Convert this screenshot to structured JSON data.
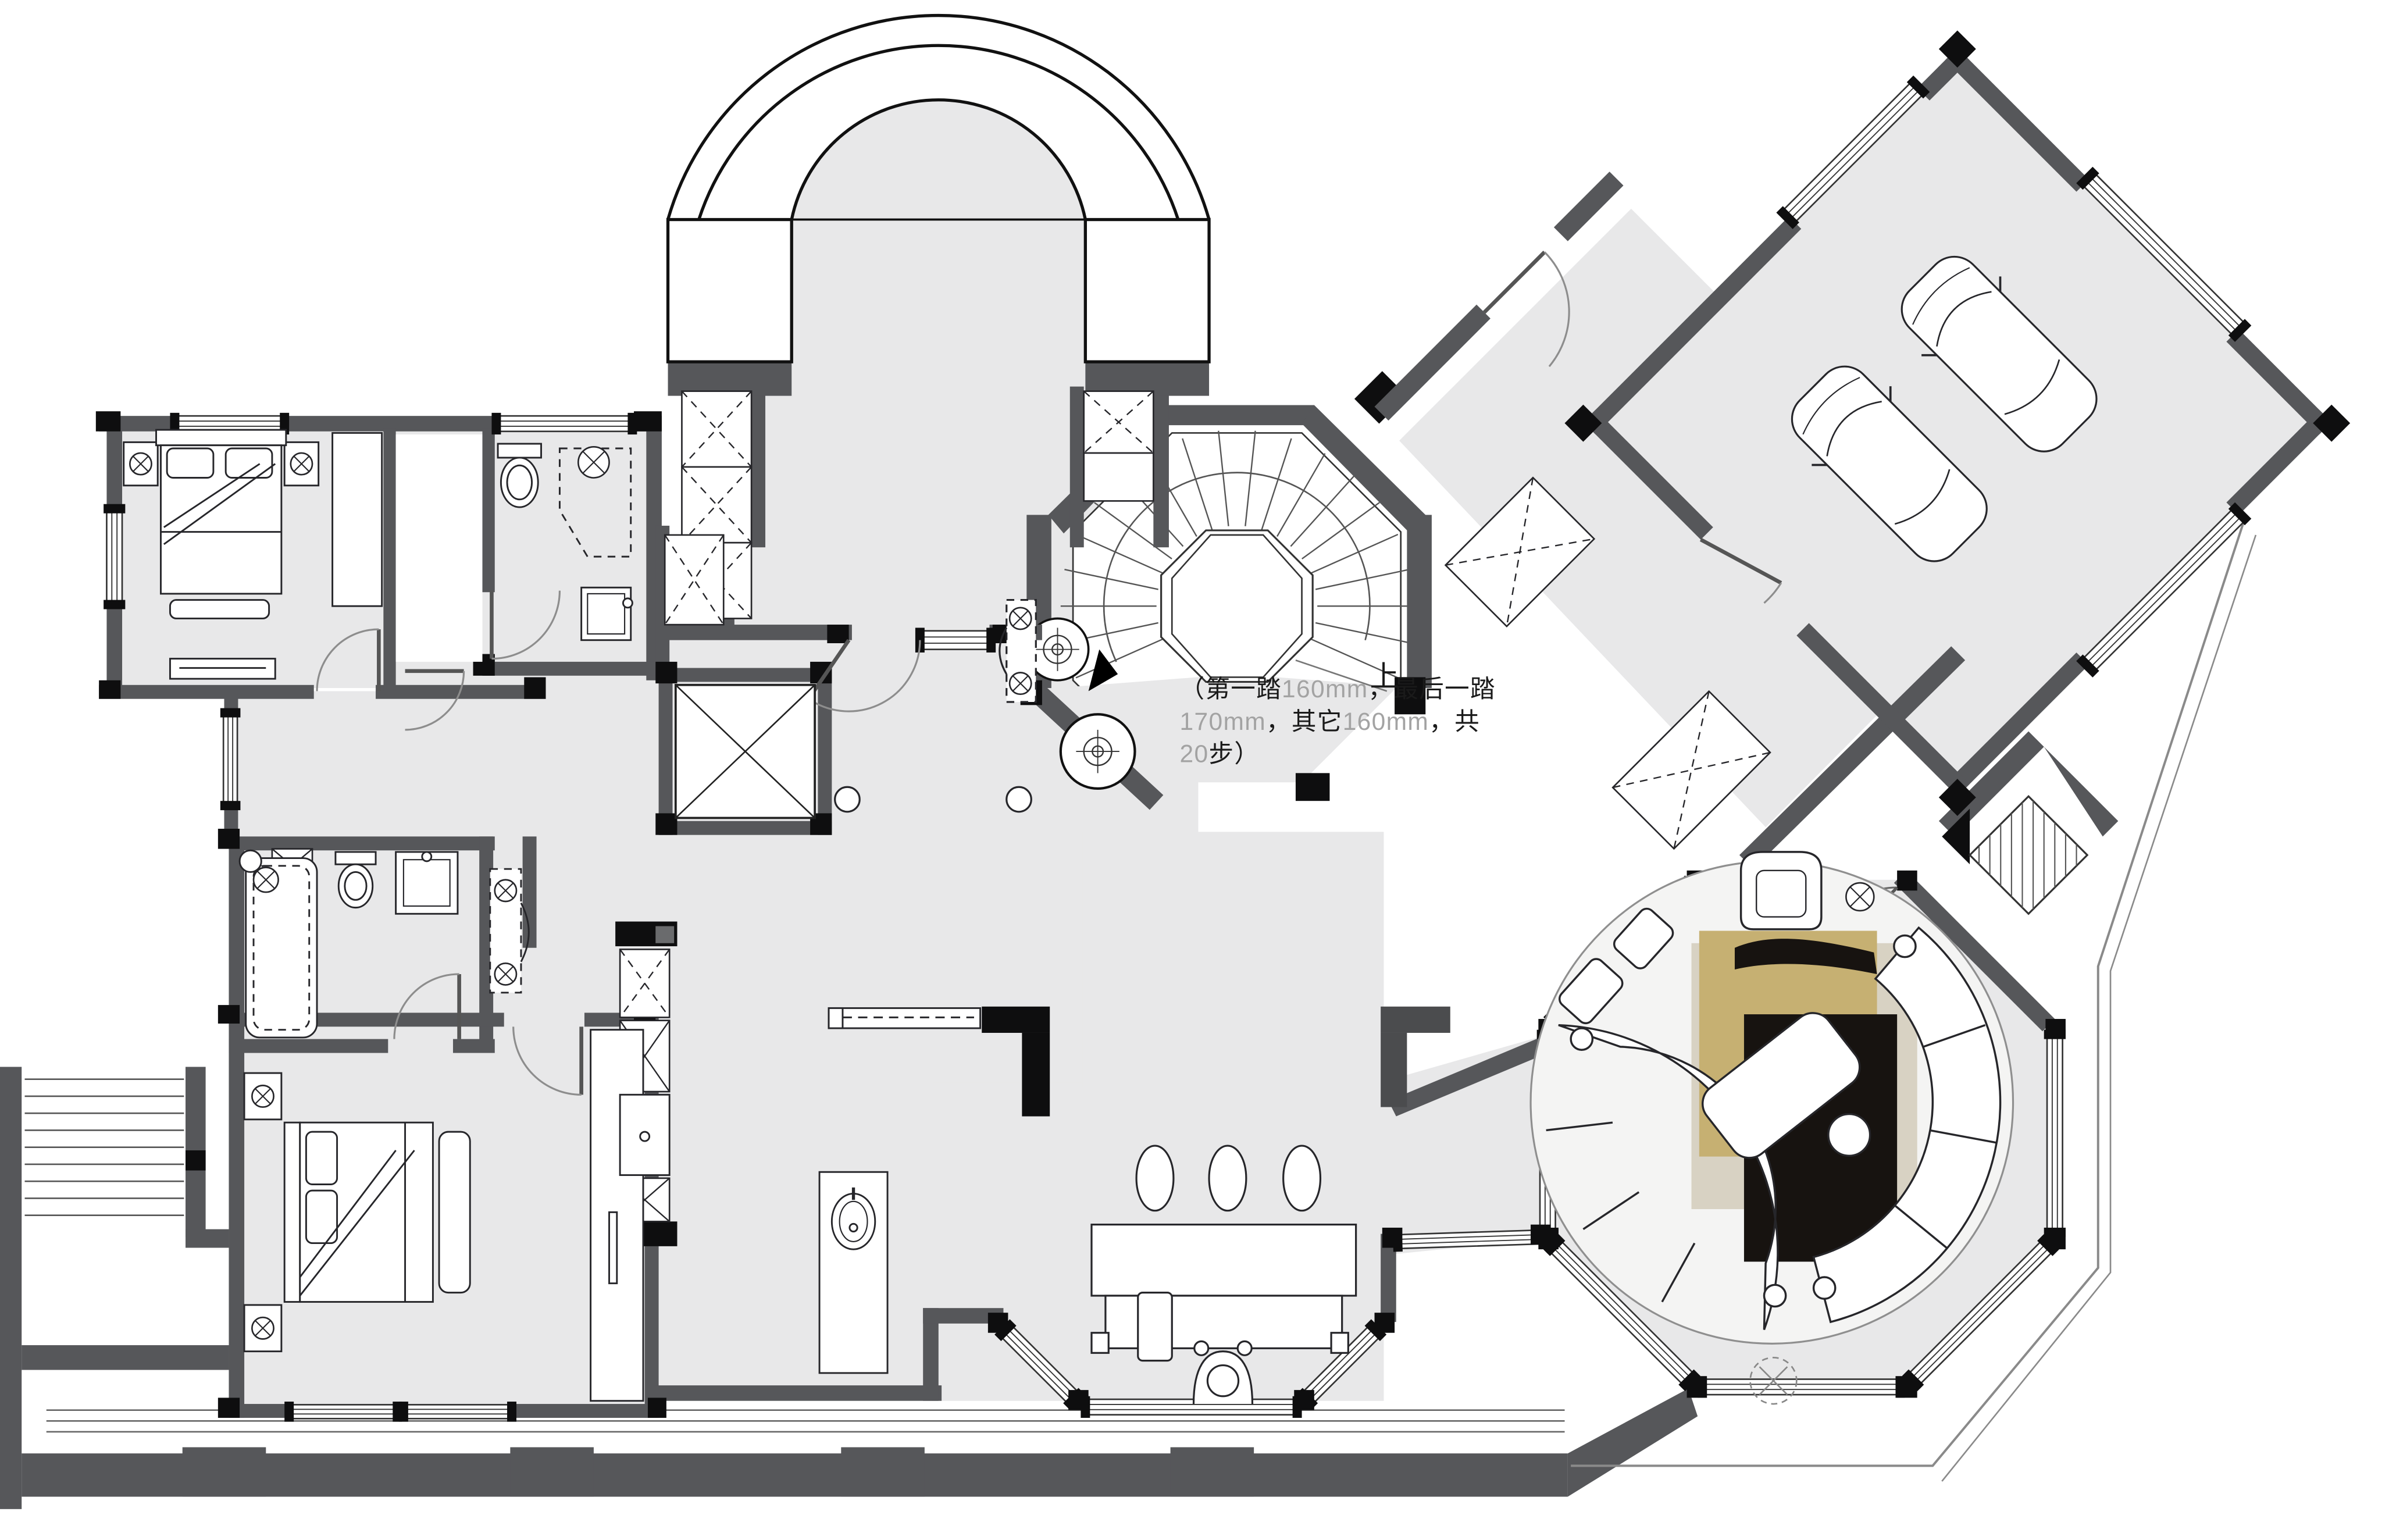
{
  "annotation": {
    "l1a": "（第一踏",
    "l1b": "160mm",
    "l1c": "，最后一踏",
    "l2a": "170mm",
    "l2b": "，其它",
    "l2c": "160mm",
    "l2d": "，共",
    "l3a": "20",
    "l3b": "步）",
    "up_label": "上"
  },
  "colors": {
    "wall": "#56575a",
    "ink": "#0e0e0f",
    "floor": "#e8e8e9",
    "paper": "#ffffff",
    "rug_gold": "#c6b072",
    "rug_beige": "#d8d2c3",
    "rug_black": "#171310",
    "rug_round": "#f4f4f3",
    "text_dark": "#1a1a1a",
    "text_gray": "#a3a3a3"
  },
  "inventory": {
    "stair_steps_total": 20,
    "first_step_mm": 160,
    "last_step_mm": 170,
    "other_steps_mm": 160,
    "beds": 2,
    "cars": 2,
    "toilets": 2,
    "bathtubs": 1,
    "showers": 1,
    "sinks": 3,
    "pendant_lamps": 3,
    "elevator": 1,
    "curved_sofas": 2,
    "armchairs": 1
  }
}
